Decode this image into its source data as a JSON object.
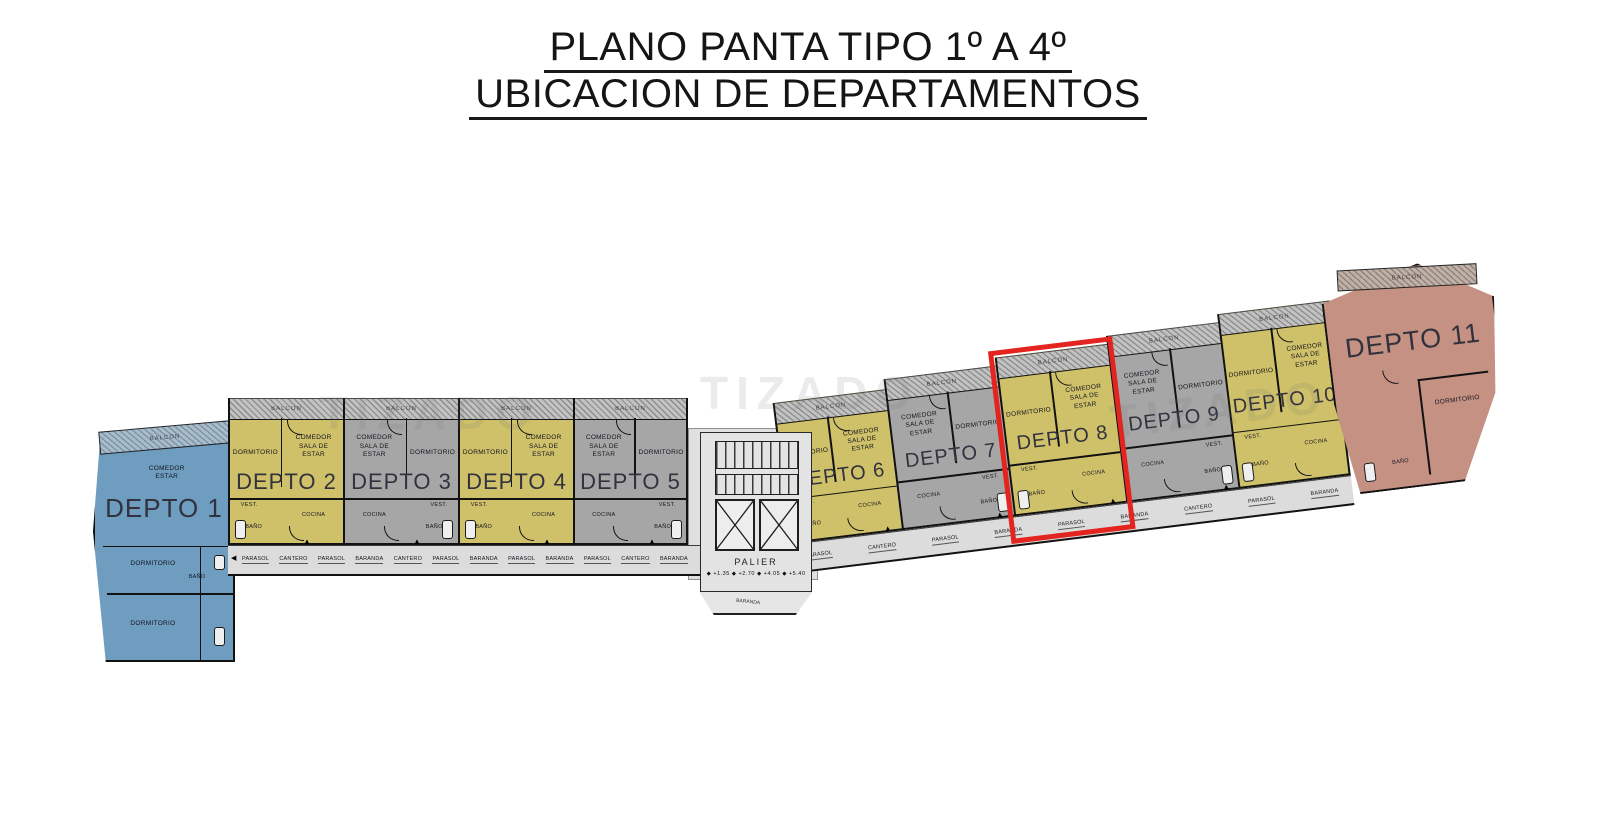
{
  "title": {
    "line1": "PLANO PANTA TIPO 1º  A 4º",
    "line2": "UBICACION DE DEPARTAMENTOS"
  },
  "watermark_text": "TIZADO",
  "room_labels": {
    "dormitorio": "DORMITORIO",
    "comedor_sala": "COMEDOR\nSALA DE\nESTAR",
    "comedor_estar": "COMEDOR\nESTAR",
    "vest": "VEST.",
    "bano": "BAÑO",
    "cocina": "COCINA",
    "balcon": "BALCON"
  },
  "apartments": [
    {
      "id": 1,
      "label": "DEPTO 1",
      "color_key": "blue"
    },
    {
      "id": 2,
      "label": "DEPTO 2",
      "color_key": "yellow",
      "mirrored": false
    },
    {
      "id": 3,
      "label": "DEPTO 3",
      "color_key": "gray",
      "mirrored": true
    },
    {
      "id": 4,
      "label": "DEPTO 4",
      "color_key": "yellow",
      "mirrored": false
    },
    {
      "id": 5,
      "label": "DEPTO 5",
      "color_key": "gray",
      "mirrored": true
    },
    {
      "id": 6,
      "label": "DEPTO 6",
      "color_key": "yellow",
      "mirrored": false
    },
    {
      "id": 7,
      "label": "DEPTO 7",
      "color_key": "gray",
      "mirrored": true
    },
    {
      "id": 8,
      "label": "DEPTO 8",
      "color_key": "yellow",
      "mirrored": false,
      "highlighted": true
    },
    {
      "id": 9,
      "label": "DEPTO 9",
      "color_key": "gray",
      "mirrored": true
    },
    {
      "id": 10,
      "label": "DEPTO 10",
      "color_key": "yellow",
      "mirrored": false
    },
    {
      "id": 11,
      "label": "DEPTO 11",
      "color_key": "salmon"
    }
  ],
  "corridor_left_labels": [
    "PARASOL",
    "CANTERO",
    "PARASOL",
    "BARANDA",
    "CANTERO",
    "PARASOL",
    "BARANDA",
    "PARASOL",
    "BARANDA",
    "PARASOL",
    "CANTERO",
    "BARANDA"
  ],
  "corridor_right_labels": [
    "PARASOL",
    "CANTERO",
    "PARASOL",
    "BARANDA",
    "PARASOL",
    "BARANDA",
    "CANTERO",
    "PARASOL",
    "BARANDA"
  ],
  "palier": {
    "label": "PALIER",
    "levels": [
      "+1.35",
      "+2.70",
      "+4.05",
      "+5.40"
    ],
    "baranda_label": "BARANDA"
  },
  "colors": {
    "yellow": "#cfc169",
    "gray": "#a6a6a6",
    "blue": "#6f9dbf",
    "salmon": "#c49183",
    "highlight": "#e3241f",
    "corridor": "#dcdcdc"
  }
}
